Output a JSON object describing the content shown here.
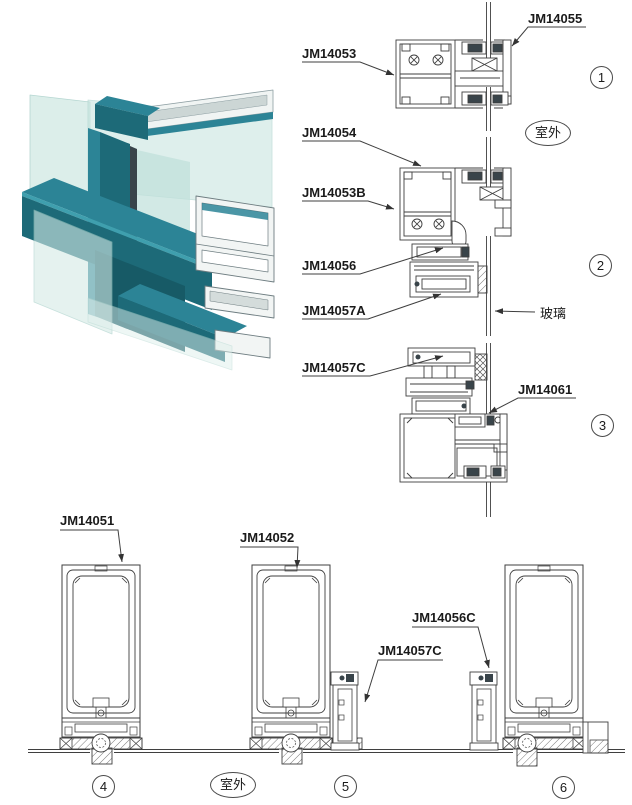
{
  "title": "aluminium-profile-section-details",
  "labels": {
    "jm14053": "JM14053",
    "jm14055": "JM14055",
    "jm14054": "JM14054",
    "jm14053b": "JM14053B",
    "jm14056": "JM14056",
    "jm14057a": "JM14057A",
    "glass_label": "玻璃",
    "jm14057c_top": "JM14057C",
    "jm14061": "JM14061",
    "jm14051": "JM14051",
    "jm14052": "JM14052",
    "jm14056c": "JM14056C",
    "jm14057c_bottom": "JM14057C",
    "outdoor": "室外"
  },
  "markers": {
    "m1": "1",
    "m2": "2",
    "m3": "3",
    "m4": "4",
    "m5": "5",
    "m6": "6"
  },
  "colors": {
    "line": "#3f3f3f",
    "teal_dark": "#1d6a78",
    "teal_mid": "#2c8496",
    "teal_light": "#3f9fae",
    "glass": "#cfe9e3",
    "aluminum": "#f2f5f4",
    "gasket": "#39444a"
  }
}
